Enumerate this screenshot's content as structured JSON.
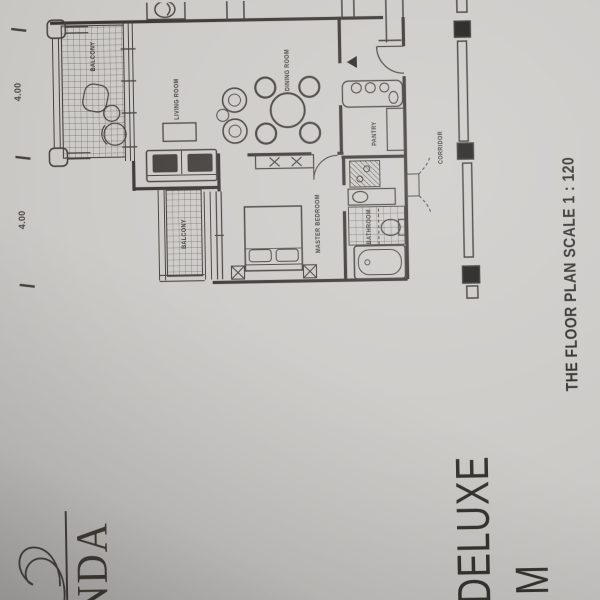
{
  "branding": {
    "logo_text_partial": "NDA",
    "unit_title_line1": "DELUXE",
    "unit_title_line2_partial": "M"
  },
  "floor_plan": {
    "scale_note": "THE FLOOR PLAN SCALE 1 : 120",
    "room_labels": {
      "balcony_living": "BALCONY",
      "living": "LIVING ROOM",
      "dining": "DINING ROOM",
      "pantry": "PANTRY",
      "master_bedroom": "MASTER BEDROOM",
      "bathroom": "BATHROOM",
      "balcony_bedroom": "BALCONY",
      "corridor": "CORRIDOR"
    },
    "dimension_labels": [
      "4.00",
      "4.00"
    ],
    "plan_icons": [
      "sofa-icon",
      "armchair-icon",
      "tv-console-icon",
      "dining-table-icon",
      "dining-chair-icon",
      "bed-icon",
      "nightstand-icon",
      "dresser-icon",
      "bathtub-icon",
      "toilet-icon",
      "sink-icon",
      "wardrobe-icon",
      "stove-burners-icon",
      "door-swing-icon",
      "lounge-chair-icon",
      "balcony-table-icon",
      "ac-unit-icon",
      "corridor-grid-line",
      "logo-flourish-icon"
    ],
    "colors": {
      "paper": "#cdcbc8",
      "ink": "#3b3835",
      "furniture_dark": "#26231f"
    }
  }
}
